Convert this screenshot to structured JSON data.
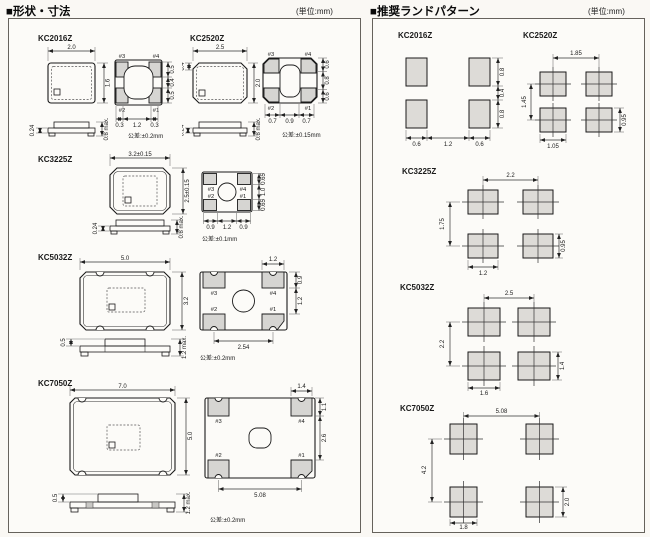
{
  "page": {
    "unit_note": "(単位:mm)"
  },
  "sections": {
    "shapes_title": "■形状・寸法",
    "land_title": "■推奨ランドパターン"
  },
  "pad_labels": {
    "p1": "#1",
    "p2": "#2",
    "p3": "#3",
    "p4": "#4"
  },
  "shapes": {
    "kc2016z": {
      "label": "KC2016Z",
      "top_w": "2.0",
      "top_h": "1.6",
      "side_t": "0.24",
      "side_h": "0.8 max.",
      "dim_h": [
        "0.3",
        "1.2",
        "0.3"
      ],
      "dim_v": [
        "0.5",
        "0.4",
        "0.5"
      ],
      "tolerance": "公差:±0.2mm"
    },
    "kc2520z": {
      "label": "KC2520Z",
      "top_w": "2.5",
      "top_h": "2.0",
      "chamfer": "0.4",
      "side_t": "0.24",
      "side_h": "0.8 max.",
      "dim_h": [
        "0.7",
        "0.9",
        "0.7"
      ],
      "dim_v": [
        "0.6",
        "0.8",
        "0.6"
      ],
      "tolerance": "公差:±0.15mm"
    },
    "kc3225z": {
      "label": "KC3225Z",
      "top_w": "3.2±0.15",
      "top_h": "2.5±0.15",
      "side_t": "0.24",
      "side_h": "0.8 max.",
      "dim_h": [
        "0.9",
        "1.2",
        "0.9"
      ],
      "dim_v": [
        "0.65",
        "1.0",
        "0.65"
      ],
      "tolerance": "公差:±0.1mm"
    },
    "kc5032z": {
      "label": "KC5032Z",
      "top_w": "5.0",
      "top_h": "3.2",
      "side_t": "0.5",
      "side_h": "1.2 max.",
      "pad_w": "1.2",
      "pad_h": "0.9",
      "pad_gap": "1.2",
      "pitch": "2.54",
      "tolerance": "公差:±0.2mm"
    },
    "kc7050z": {
      "label": "KC7050Z",
      "top_w": "7.0",
      "top_h": "5.0",
      "side_t": "0.5",
      "side_h": "1.2 max.",
      "pad_w": "1.4",
      "pad_h": "1.1",
      "pad_gap": "2.6",
      "pitch": "5.08",
      "tolerance": "公差:±0.2mm"
    }
  },
  "land": {
    "kc2016z": {
      "label": "KC2016Z",
      "dim_h": [
        "0.6",
        "1.2",
        "0.6"
      ],
      "dim_v": [
        "0.8",
        "0.4",
        "0.8"
      ]
    },
    "kc2520z": {
      "label": "KC2520Z",
      "pitch_x": "1.85",
      "pitch_y": "1.45",
      "pad_w": "1.05",
      "pad_h": "0.95"
    },
    "kc3225z": {
      "label": "KC3225Z",
      "pitch_x": "2.2",
      "pitch_y": "1.75",
      "pad_w": "1.2",
      "pad_h": "0.95"
    },
    "kc5032z": {
      "label": "KC5032Z",
      "pitch_x": "2.5",
      "pitch_y": "2.2",
      "pad_w": "1.6",
      "pad_h": "1.4"
    },
    "kc7050z": {
      "label": "KC7050Z",
      "pitch_x": "5.08",
      "pitch_y": "4.2",
      "pad_w": "1.8",
      "pad_h": "2.0"
    }
  }
}
